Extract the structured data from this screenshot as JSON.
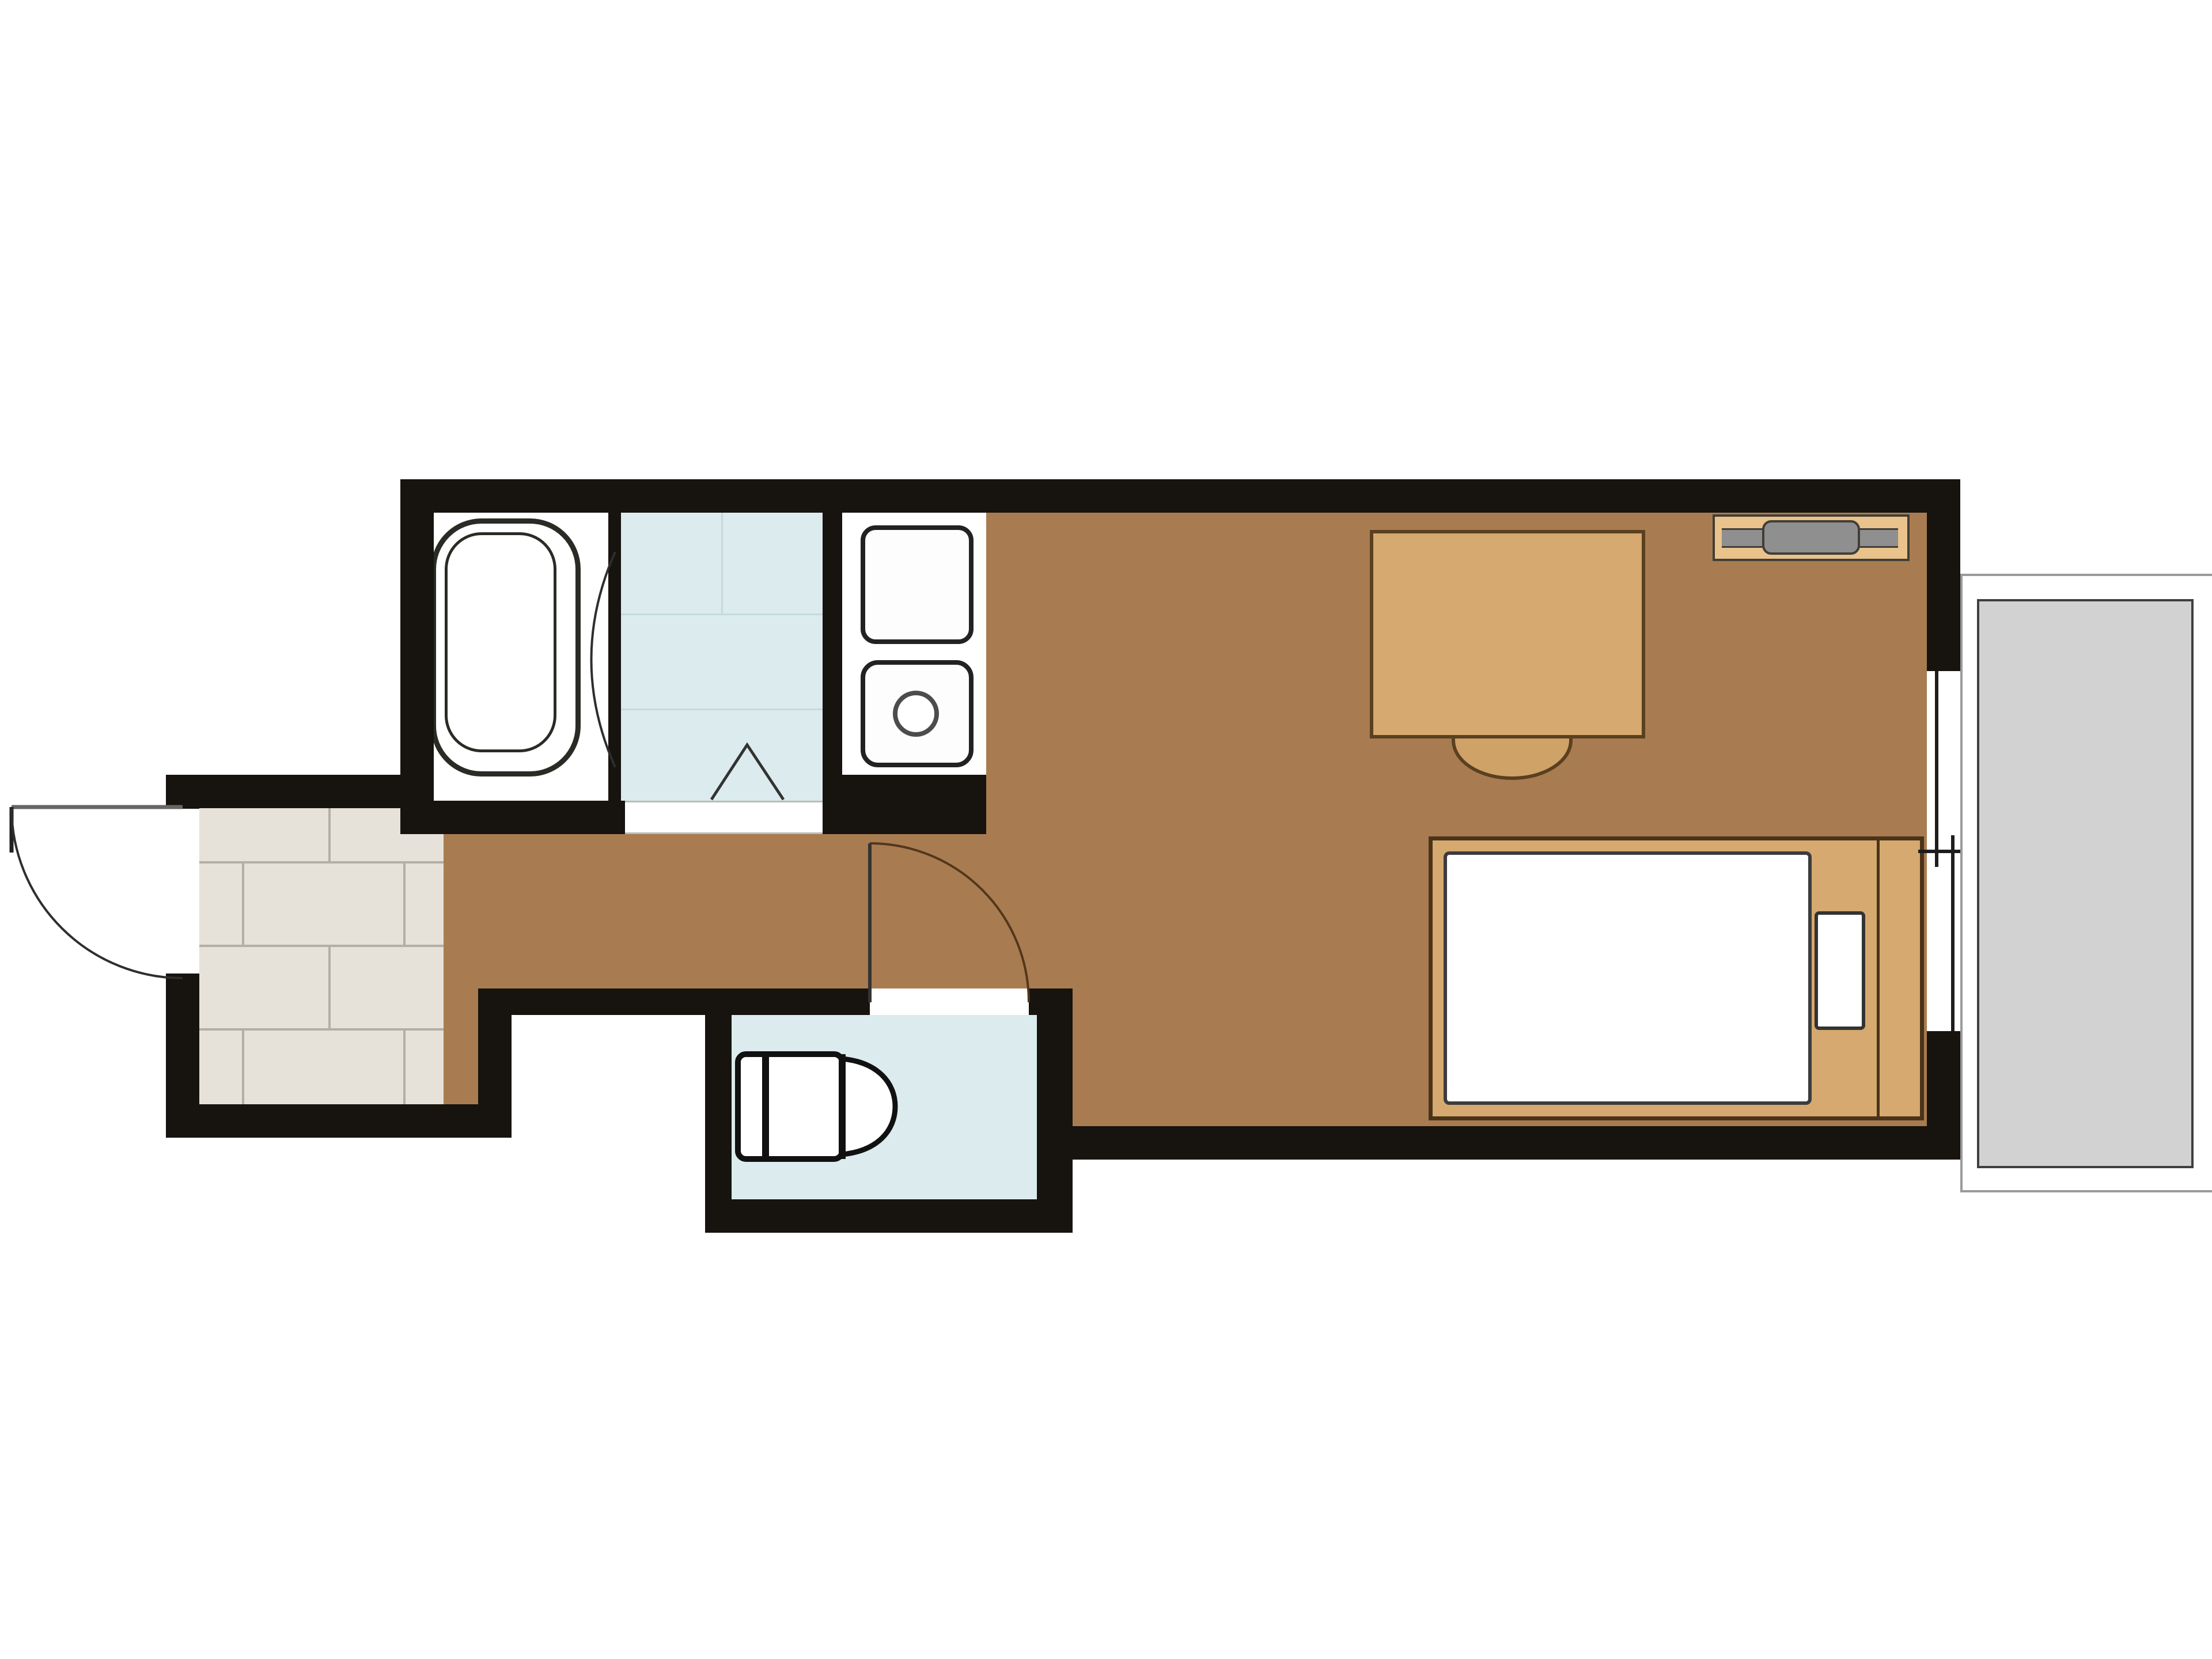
{
  "colors": {
    "wall": "#17130e",
    "wood_floor": "#a87c50",
    "tile_floor": "#e6e2d9",
    "tile_grout": "#b3afa5",
    "wet_blue": "#dcebed",
    "wet_line": "#c4dade",
    "balcony_gray": "#d2d2d2",
    "white": "#ffffff",
    "tan": "#d5a96f",
    "tan_dark": "#cfa268",
    "ac_tan": "#eac28b",
    "ac_gray": "#8f8f8f",
    "outline": "#2b2b26",
    "wood_outline": "#5a4020",
    "arc_brown": "#54361c",
    "leaf_gray": "#666666"
  },
  "rooms": [
    {
      "key": "entrance-genkan",
      "floor": "tile"
    },
    {
      "key": "hallway",
      "floor": "wood"
    },
    {
      "key": "bathroom",
      "floor": "white"
    },
    {
      "key": "washroom",
      "floor": "wet-blue"
    },
    {
      "key": "kitchen",
      "floor": "white"
    },
    {
      "key": "toilet-room",
      "floor": "wet-blue"
    },
    {
      "key": "main-room",
      "floor": "wood"
    },
    {
      "key": "balcony",
      "floor": "gray"
    }
  ],
  "furniture": [
    "bathtub",
    "kitchen-sink",
    "single-burner-stove",
    "desk",
    "chair",
    "air-conditioner",
    "single-bed",
    "mattress",
    "pillow",
    "toilet"
  ],
  "openings": [
    "entrance-door-swing-out",
    "toilet-door-swing-in",
    "bathroom-door-arc",
    "washroom-folding-door-mark",
    "balcony-sliding-window"
  ]
}
